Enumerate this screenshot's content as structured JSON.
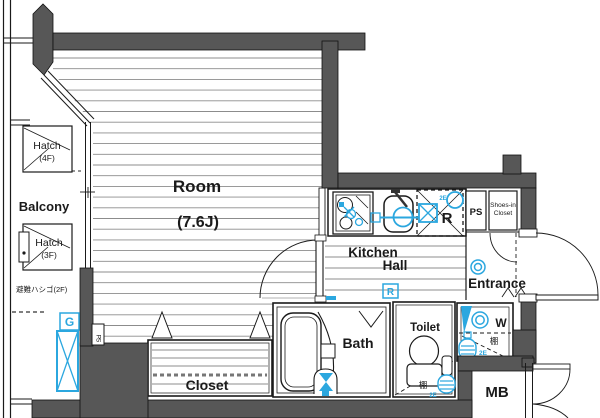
{
  "floorplan": {
    "labels": {
      "room": "Room",
      "room_size": "(7.6J)",
      "balcony": "Balcony",
      "kitchen": "Kitchen",
      "hall": "Hall",
      "entrance": "Entrance",
      "bath": "Bath",
      "toilet": "Toilet",
      "closet": "Closet",
      "mb": "MB",
      "ps": "PS",
      "ps_shaft": "PS",
      "shoes_closet_line1": "Shoes-in",
      "shoes_closet_line2": "Closet",
      "washer": "W",
      "fridge": "R",
      "gas_meter": "G",
      "hall_outlet": "R",
      "hatch_4f_line1": "Hatch",
      "hatch_4f_line2": "(4F)",
      "hatch_3f_line1": "Hatch",
      "hatch_3f_line2": "(3F)",
      "escape_ladder": "避難ハシゴ(2F)",
      "shelf_toilet": "棚",
      "shelf_washer": "棚",
      "outlet_2e_kitchen": "2E",
      "outlet_2e_washer": "2E",
      "outlet_2e_toilet": "2E"
    },
    "colors": {
      "wall": "#575757",
      "line": "#1a1a1a",
      "floor_line": "#8c8c8c",
      "fixture_blue": "#2ba7df"
    }
  }
}
